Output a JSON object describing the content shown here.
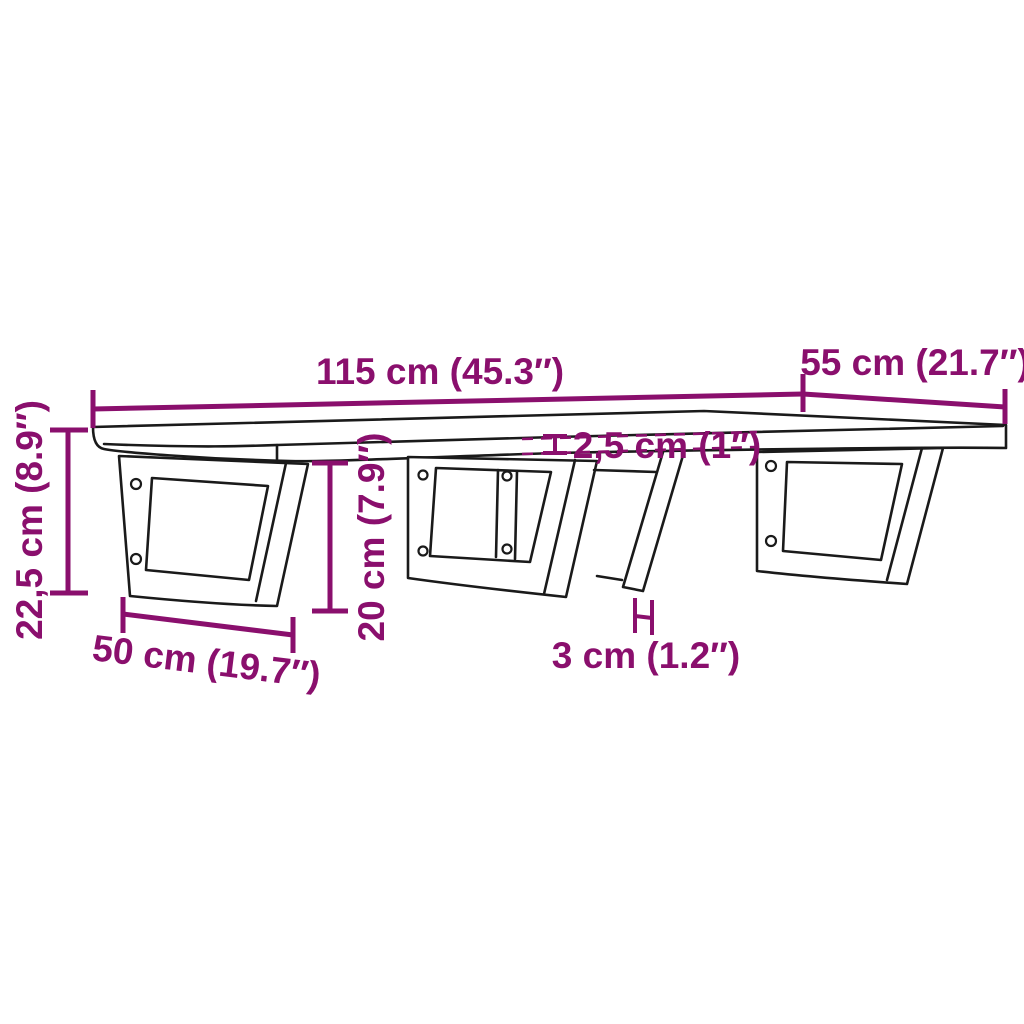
{
  "diagram": {
    "kind": "product-dimension-diagram",
    "subject": "wall-mounted shelf board with steel brackets",
    "colors": {
      "accent": "#8A0F6D",
      "outline": "#1A1A1A",
      "background": "#FFFFFF"
    },
    "dimensions": {
      "board_width": "115 cm (45.3″)",
      "board_depth": "55 cm (21.7″)",
      "total_height": "22,5 cm (8.9″)",
      "bracket_height": "20 cm (7.9″)",
      "board_thickness": "2,5 cm (1″)",
      "bar_width": "3 cm (1.2″)",
      "bracket_depth": "50 cm (19.7″)"
    }
  }
}
